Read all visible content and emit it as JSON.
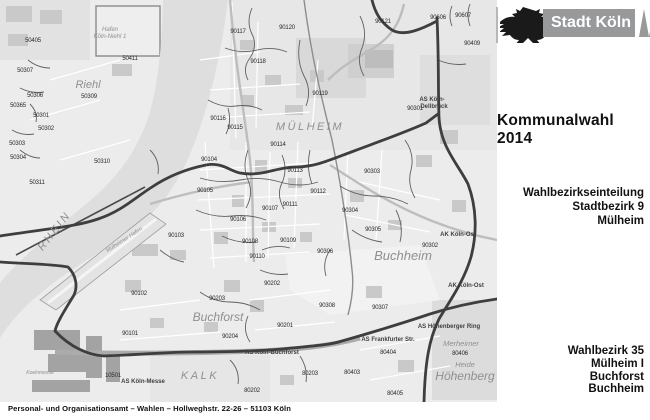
{
  "header": {
    "logo_text": "Stadt Köln",
    "title": "Kommunalwahl 2014"
  },
  "right_panel": {
    "subtitle_lines": [
      "Wahlbezirkseinteilung",
      "Stadtbezirk 9",
      "Mülheim"
    ],
    "district_lines": [
      "Wahlbezirk 35",
      "Mülheim I",
      "Buchforst",
      "Buchheim"
    ]
  },
  "footer": {
    "text": "Personal- und Organisationsamt – Wahlen – Hollweghstr. 22-26 – 51103 Köln"
  },
  "colors": {
    "logo_gray": "#97999b",
    "boundary_dark": "#3e3e3e",
    "river_gray": "#dedede"
  },
  "map": {
    "district_labels": [
      {
        "id": "50405",
        "x": 33,
        "y": 42
      },
      {
        "id": "50411",
        "x": 130,
        "y": 60
      },
      {
        "id": "50307",
        "x": 25,
        "y": 72
      },
      {
        "id": "50306",
        "x": 35,
        "y": 97
      },
      {
        "id": "50309",
        "x": 89,
        "y": 98
      },
      {
        "id": "50365",
        "x": 18,
        "y": 107
      },
      {
        "id": "50301",
        "x": 41,
        "y": 117
      },
      {
        "id": "50302",
        "x": 46,
        "y": 130
      },
      {
        "id": "50303",
        "x": 17,
        "y": 145
      },
      {
        "id": "50304",
        "x": 18,
        "y": 159
      },
      {
        "id": "50310",
        "x": 102,
        "y": 163
      },
      {
        "id": "50311",
        "x": 37,
        "y": 184
      },
      {
        "id": "90117",
        "x": 238,
        "y": 33
      },
      {
        "id": "90120",
        "x": 287,
        "y": 29
      },
      {
        "id": "90121",
        "x": 383,
        "y": 23
      },
      {
        "id": "90606",
        "x": 438,
        "y": 19
      },
      {
        "id": "90607",
        "x": 463,
        "y": 17
      },
      {
        "id": "90409",
        "x": 472,
        "y": 45
      },
      {
        "id": "90118",
        "x": 258,
        "y": 63
      },
      {
        "id": "90119",
        "x": 320,
        "y": 95
      },
      {
        "id": "90301",
        "x": 415,
        "y": 110
      },
      {
        "id": "90116",
        "x": 218,
        "y": 120
      },
      {
        "id": "90115",
        "x": 235,
        "y": 129
      },
      {
        "id": "90114",
        "x": 278,
        "y": 146
      },
      {
        "id": "90104",
        "x": 209,
        "y": 161
      },
      {
        "id": "90113",
        "x": 295,
        "y": 172
      },
      {
        "id": "90303",
        "x": 372,
        "y": 173
      },
      {
        "id": "90105",
        "x": 205,
        "y": 192
      },
      {
        "id": "90112",
        "x": 318,
        "y": 193
      },
      {
        "id": "90111",
        "x": 290,
        "y": 206
      },
      {
        "id": "90107",
        "x": 270,
        "y": 210
      },
      {
        "id": "90304",
        "x": 350,
        "y": 212
      },
      {
        "id": "90106",
        "x": 238,
        "y": 221
      },
      {
        "id": "90305",
        "x": 373,
        "y": 231
      },
      {
        "id": "90103",
        "x": 176,
        "y": 237
      },
      {
        "id": "90109",
        "x": 288,
        "y": 242
      },
      {
        "id": "90108",
        "x": 250,
        "y": 243
      },
      {
        "id": "90302",
        "x": 430,
        "y": 247
      },
      {
        "id": "90306",
        "x": 325,
        "y": 253
      },
      {
        "id": "90110",
        "x": 257,
        "y": 258
      },
      {
        "id": "90202",
        "x": 272,
        "y": 285
      },
      {
        "id": "90102",
        "x": 139,
        "y": 295
      },
      {
        "id": "90203",
        "x": 217,
        "y": 300
      },
      {
        "id": "90308",
        "x": 327,
        "y": 307
      },
      {
        "id": "90307",
        "x": 380,
        "y": 309
      },
      {
        "id": "90201",
        "x": 285,
        "y": 327
      },
      {
        "id": "90101",
        "x": 130,
        "y": 335
      },
      {
        "id": "90204",
        "x": 230,
        "y": 338
      },
      {
        "id": "80404",
        "x": 388,
        "y": 354
      },
      {
        "id": "80406",
        "x": 460,
        "y": 355
      },
      {
        "id": "80403",
        "x": 352,
        "y": 374
      },
      {
        "id": "80203",
        "x": 310,
        "y": 375
      },
      {
        "id": "10501",
        "x": 113,
        "y": 377
      },
      {
        "id": "80202",
        "x": 252,
        "y": 392
      },
      {
        "id": "80405",
        "x": 395,
        "y": 395
      }
    ],
    "place_labels": [
      {
        "text": "Hafen",
        "x": 110,
        "y": 31,
        "size": 6
      },
      {
        "text": "Köln-Niehl 1",
        "x": 110,
        "y": 38,
        "size": 6
      },
      {
        "text": "Riehl",
        "x": 88,
        "y": 88,
        "size": 11,
        "cls": "big"
      },
      {
        "text": "MÜLHEIM",
        "x": 310,
        "y": 130,
        "size": 11,
        "cls": "caps"
      },
      {
        "text": "RHEIN",
        "x": 57,
        "y": 233,
        "size": 11,
        "cls": "caps",
        "rotate": -52
      },
      {
        "text": "Mülheimer Hafen",
        "x": 125,
        "y": 241,
        "size": 5.5,
        "rotate": -33
      },
      {
        "text": "Buchheim",
        "x": 403,
        "y": 260,
        "size": 13
      },
      {
        "text": "Buchforst",
        "x": 218,
        "y": 321,
        "size": 12
      },
      {
        "text": "Merheimer",
        "x": 461,
        "y": 346,
        "size": 7.5
      },
      {
        "text": "Heide",
        "x": 465,
        "y": 367,
        "size": 7.5
      },
      {
        "text": "Höhenberg",
        "x": 465,
        "y": 380,
        "size": 12
      },
      {
        "text": "KALK",
        "x": 200,
        "y": 379,
        "size": 11,
        "cls": "caps"
      },
      {
        "text": "Koelnmesse",
        "x": 40,
        "y": 374,
        "size": 5
      }
    ],
    "road_labels": [
      {
        "text": "AS Köln-",
        "x": 432,
        "y": 101
      },
      {
        "text": "Dellbrück",
        "x": 434,
        "y": 108
      },
      {
        "text": "AK Köln-Ost",
        "x": 458,
        "y": 236
      },
      {
        "text": "AK Köln-Ost",
        "x": 466,
        "y": 287
      },
      {
        "text": "AS Höhenberger Ring",
        "x": 449,
        "y": 328
      },
      {
        "text": "AS Frankfurter Str.",
        "x": 388,
        "y": 341
      },
      {
        "text": "AS Köln-Buchforst",
        "x": 272,
        "y": 354
      },
      {
        "text": "AS Köln-Messe",
        "x": 143,
        "y": 383
      }
    ]
  }
}
